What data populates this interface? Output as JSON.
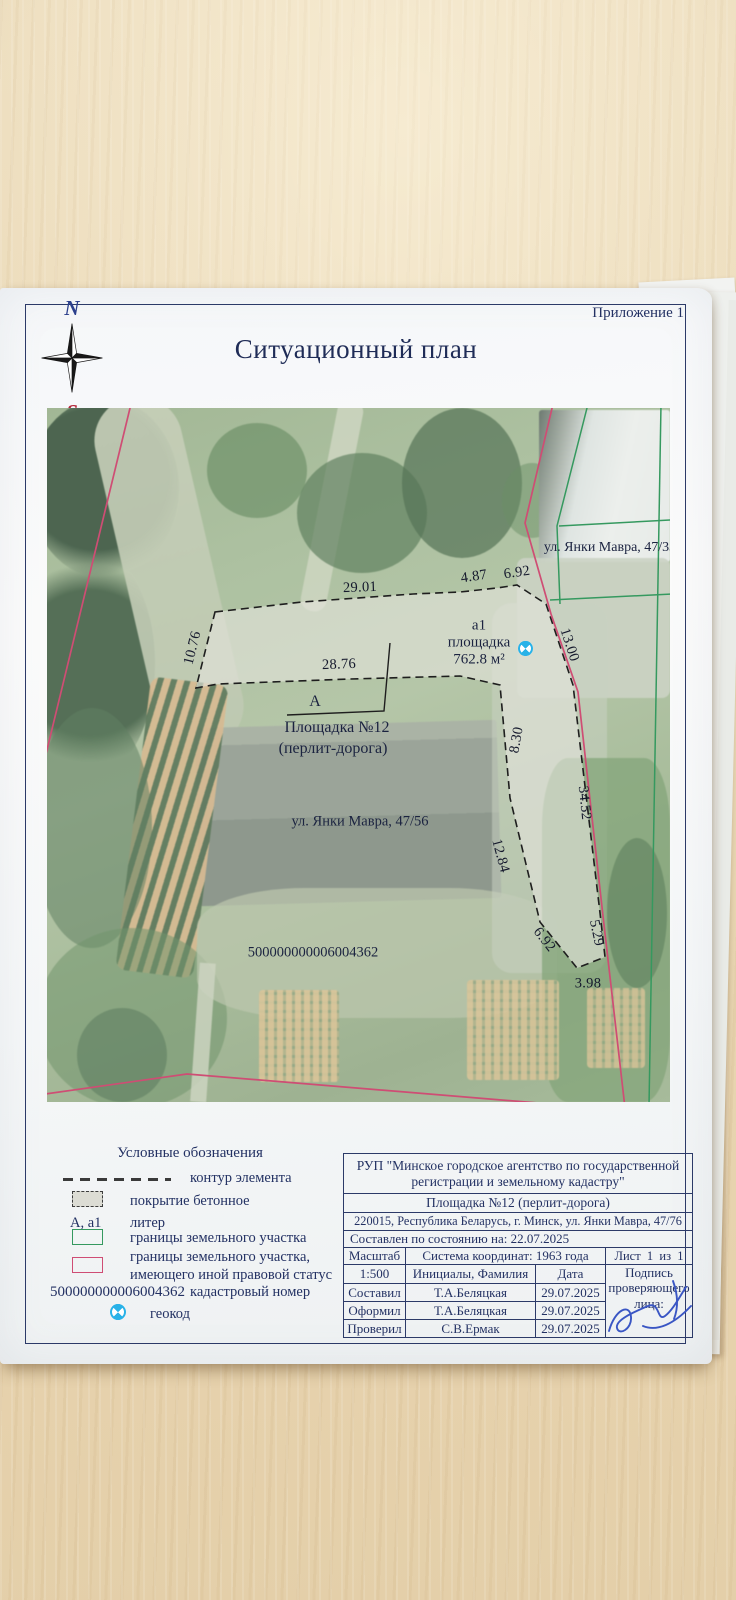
{
  "doc": {
    "appendix": "Приложение 1",
    "title": "Ситуационный план",
    "compass": {
      "north": "N",
      "south": "S"
    }
  },
  "map": {
    "labels": {
      "street_top": "ул. Янки Мавра, 47/33",
      "site_letter": "a1",
      "site_name": "площадка",
      "site_area": "762.8 м²",
      "callout_letter": "А",
      "callout_name": "Площадка №12",
      "callout_detail": "(перлит-дорога)",
      "street_mid": "ул. Янки Мавра, 47/56",
      "cadastral": "500000000006004362"
    },
    "dimensions": [
      "29.01",
      "4.87",
      "6.92",
      "10.76",
      "28.76",
      "13.00",
      "8.30",
      "12.84",
      "6.92",
      "34.52",
      "5.29",
      "3.98"
    ]
  },
  "legend": {
    "title": "Условные обозначения",
    "items": [
      {
        "label": "контур элемента"
      },
      {
        "label": "покрытие бетонное"
      },
      {
        "symbol": "А, a1",
        "label": "литер"
      },
      {
        "label": "границы земельного участка"
      },
      {
        "label": "границы земельного участка,\nимеющего иной правовой статус"
      },
      {
        "value": "500000000006004362",
        "label": "кадастровый номер"
      },
      {
        "label": "геокод"
      }
    ]
  },
  "titleblock": {
    "agency": "РУП \"Минское городское агентство по государственной регистрации и земельному кадастру\"",
    "object": "Площадка №12 (перлит-дорога)",
    "address": "220015, Республика Беларусь, г. Минск, ул. Янки Мавра, 47/76",
    "compiled": "Составлен по состоянию на: 22.07.2025",
    "scale_label": "Масштаб",
    "scale_value": "1:500",
    "coord_system": "Система координат: 1963 года",
    "sheet": "Лист  1  из  1",
    "name_header": "Инициалы, Фамилия",
    "date_header": "Дата",
    "sign_label": "Подпись проверяющего лица:",
    "rows": [
      {
        "role": "Составил",
        "name": "Т.А.Беляцкая",
        "date": "29.07.2025"
      },
      {
        "role": "Оформил",
        "name": "Т.А.Беляцкая",
        "date": "29.07.2025"
      },
      {
        "role": "Проверил",
        "name": "С.В.Ермак",
        "date": "29.07.2025"
      }
    ]
  },
  "colors": {
    "ink_navy": "#233163",
    "boundary_green": "#35995f",
    "boundary_pink": "#cf4d74",
    "geocode_blue": "#29b2e8",
    "signature_blue": "#3a56c4",
    "concrete_gray": "#e4e3dc"
  }
}
